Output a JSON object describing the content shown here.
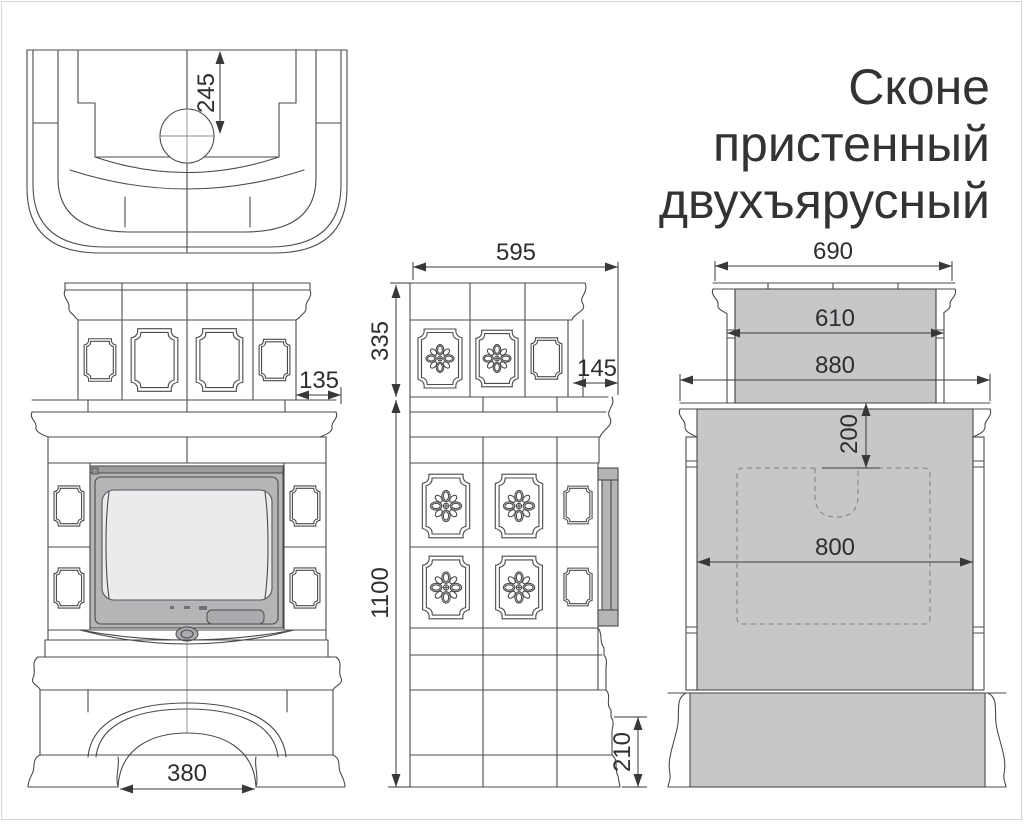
{
  "title": {
    "line1": "Сконе",
    "line2": "пристенный",
    "line3": "двухъярусный"
  },
  "views": {
    "plan": {
      "dims": {
        "chimney_center_to_back": "245"
      }
    },
    "front": {
      "dims": {
        "upper_tier_side_inset": "135",
        "hearth_arch_width": "380"
      }
    },
    "side": {
      "dims": {
        "upper_tier_depth": "595",
        "upper_tier_height": "335",
        "body_height": "1100",
        "front_ledge_depth": "145",
        "plinth_height": "210"
      }
    },
    "back": {
      "dims": {
        "upper_cornice_width": "690",
        "upper_tier_width": "610",
        "lower_cornice_width": "880",
        "flue_cutout_drop": "200",
        "body_width": "800"
      }
    }
  },
  "colors": {
    "line": "#4b4b4e",
    "dim_text": "#2e2e31",
    "wall_contact_fill": "#c6c7c9",
    "door_fill": "#b4b5b7",
    "glass_fill": "#eaebed"
  }
}
